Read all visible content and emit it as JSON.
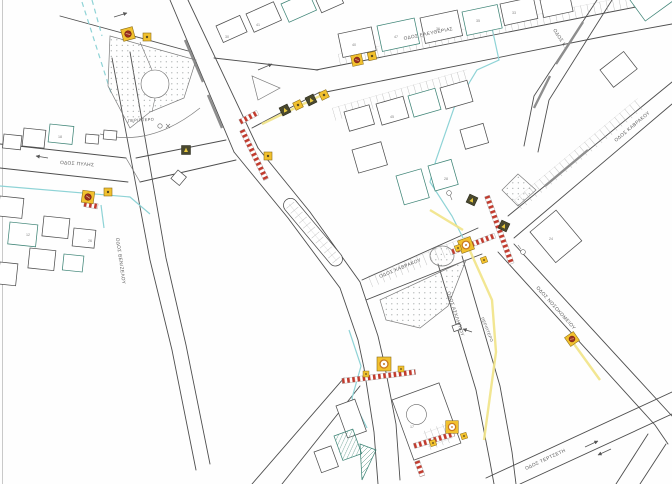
{
  "streets": {
    "eleftherias": "ΟΔΟΣ ΕΛΕΥΘΕΡΙΑΣ",
    "pylis": "ΟΔΟΣ ΠΥΛΗΣ",
    "venizelou": "ΟΔΟΣ ΒΕΝΙΖΕΛΟΥ",
    "kavrakou_lower": "ΟΔΟΣ ΚΑΒΡΑΚΟΥ",
    "kavrakou_upper": "ΟΔΟΣ ΚΑΒΡΑΚΟΥ",
    "asklipiou": "ΟΔΟΣ ΑΣΚΛΗΠΙΟΥ",
    "nosokomeiou": "ΟΔΟΣ ΝΟΣΟΚΟΜΕΙΟΥ",
    "tertseti": "ΟΔΟΣ ΤΕΡΤΣΕΤΗ",
    "ne_corner": "ΟΔΟΣ Κ."
  },
  "annotations": {
    "kiosk_1": "ΠΕΡΙΠΤΕΡΟ",
    "kiosk_2": "ΠΕΡΙΠΤΕΡΟ"
  },
  "block_numbers": [
    "30",
    "41",
    "40",
    "47",
    "36",
    "35",
    "33",
    "45",
    "28",
    "24",
    "18",
    "12",
    "17",
    "26"
  ],
  "colors": {
    "line-dark": "#4e4e4e",
    "teal": "#3f8577",
    "utility-cyan": "#8ed3d6",
    "lane-yellow": "#f1e386",
    "signal-yellow": "#f2c12e",
    "signal-red": "#9e2f1f",
    "crosswalk-red": "#c23b2e",
    "median-gray": "#8d8d8d",
    "dot-gray": "#9aa0a0"
  }
}
